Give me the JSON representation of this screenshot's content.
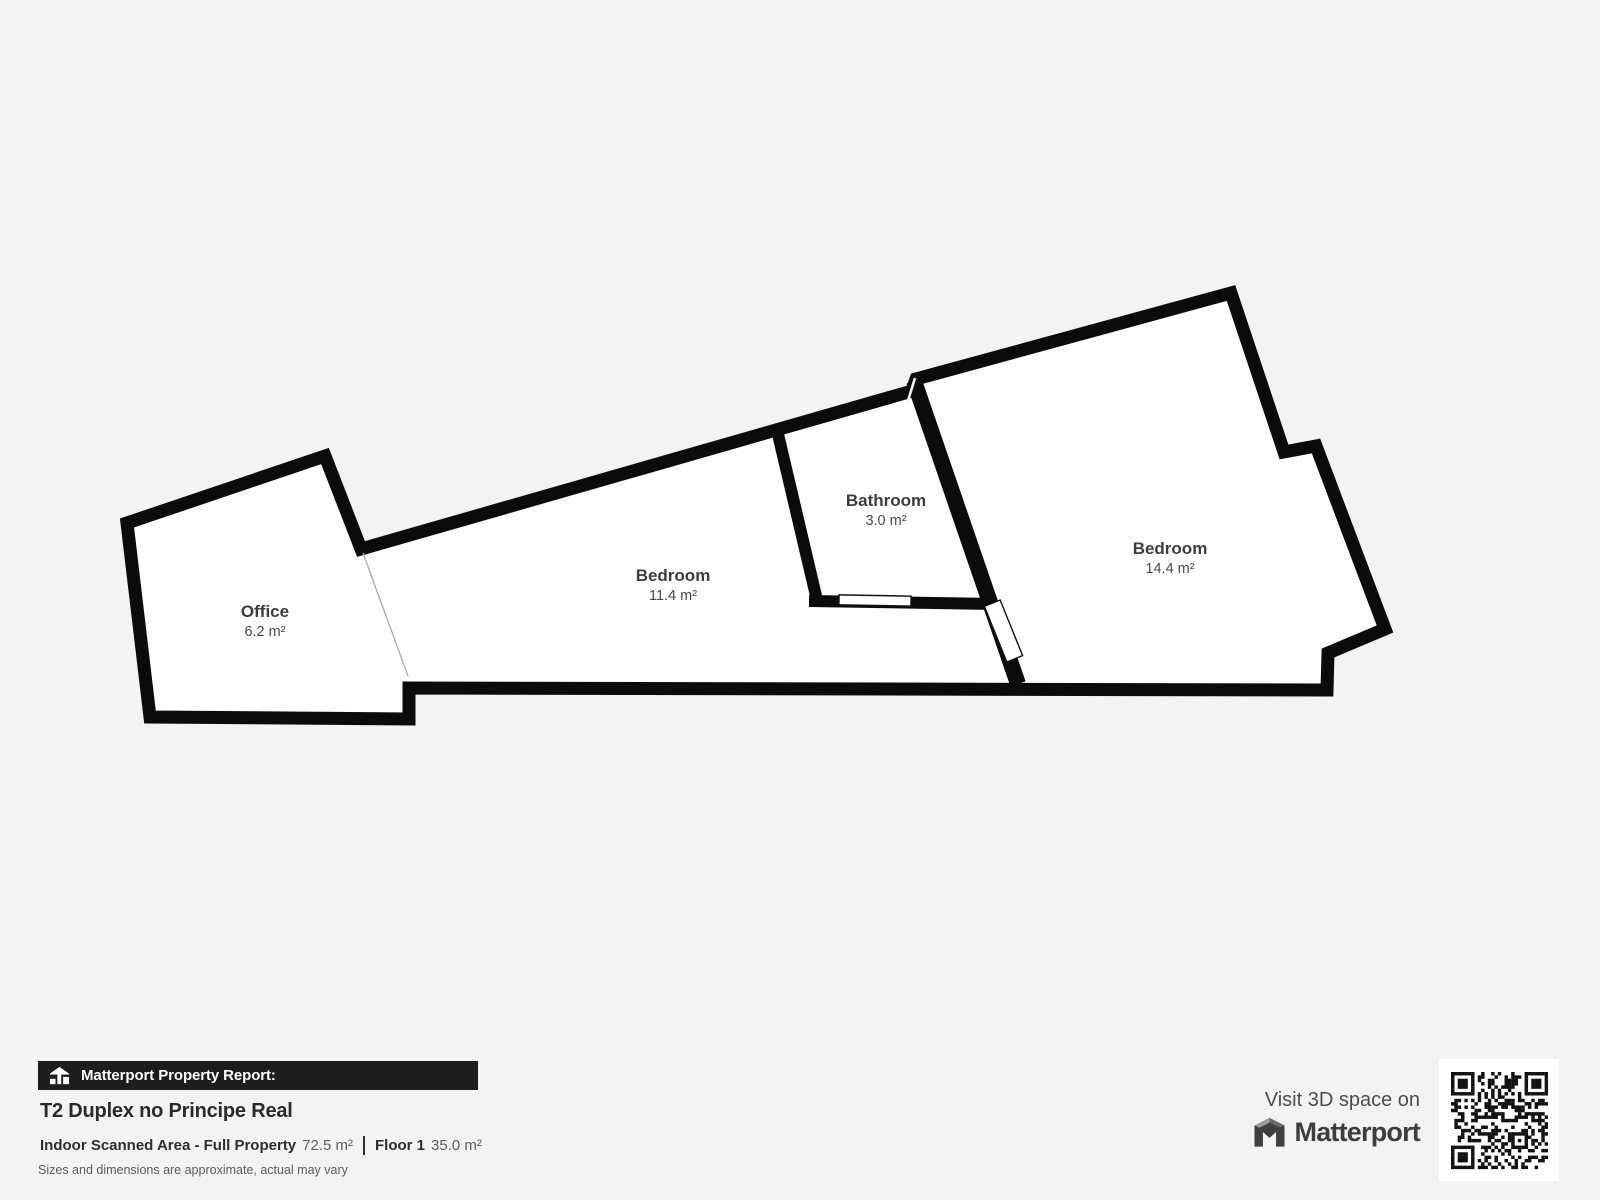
{
  "page": {
    "background": "#f4f3f1"
  },
  "plan": {
    "wall_color": "#0b0b0b",
    "room_fill": "#ffffff",
    "label_color": "#3d3d3d",
    "rooms": [
      {
        "name": "Office",
        "area": "6.2 m²"
      },
      {
        "name": "Bedroom",
        "area": "11.4 m²"
      },
      {
        "name": "Bathroom",
        "area": "3.0 m²"
      },
      {
        "name": "Bedroom",
        "area": "14.4 m²"
      }
    ]
  },
  "report": {
    "banner_label": "Matterport Property Report:",
    "banner_bg": "#1d1d1b",
    "property_title": "T2 Duplex no Principe Real",
    "stats": [
      {
        "label": "Indoor Scanned Area - Full Property",
        "value": "72.5 m²"
      },
      {
        "label": "Floor 1",
        "value": "35.0 m²"
      }
    ],
    "disclaimer": "Sizes and dimensions are approximate, actual may vary"
  },
  "promo": {
    "visit_label": "Visit 3D space on",
    "brand_name": "Matterport"
  }
}
